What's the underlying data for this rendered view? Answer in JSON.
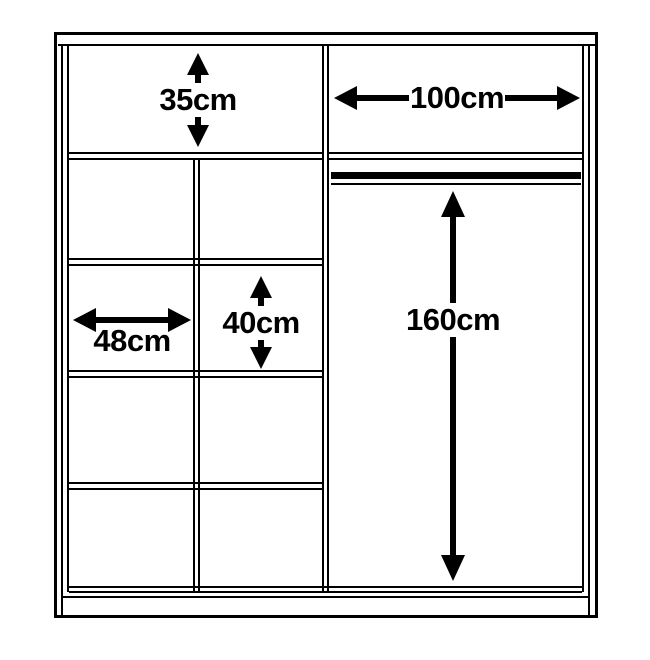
{
  "diagram": {
    "name": "wardrobe interior dimensions",
    "background_color": "#ffffff",
    "line_color": "#000000",
    "labels": {
      "top_shelf_height": "35cm",
      "right_section_width": "100cm",
      "left_column_width": "48cm",
      "middle_shelf_height": "40cm",
      "hanging_space_height": "160cm"
    }
  }
}
